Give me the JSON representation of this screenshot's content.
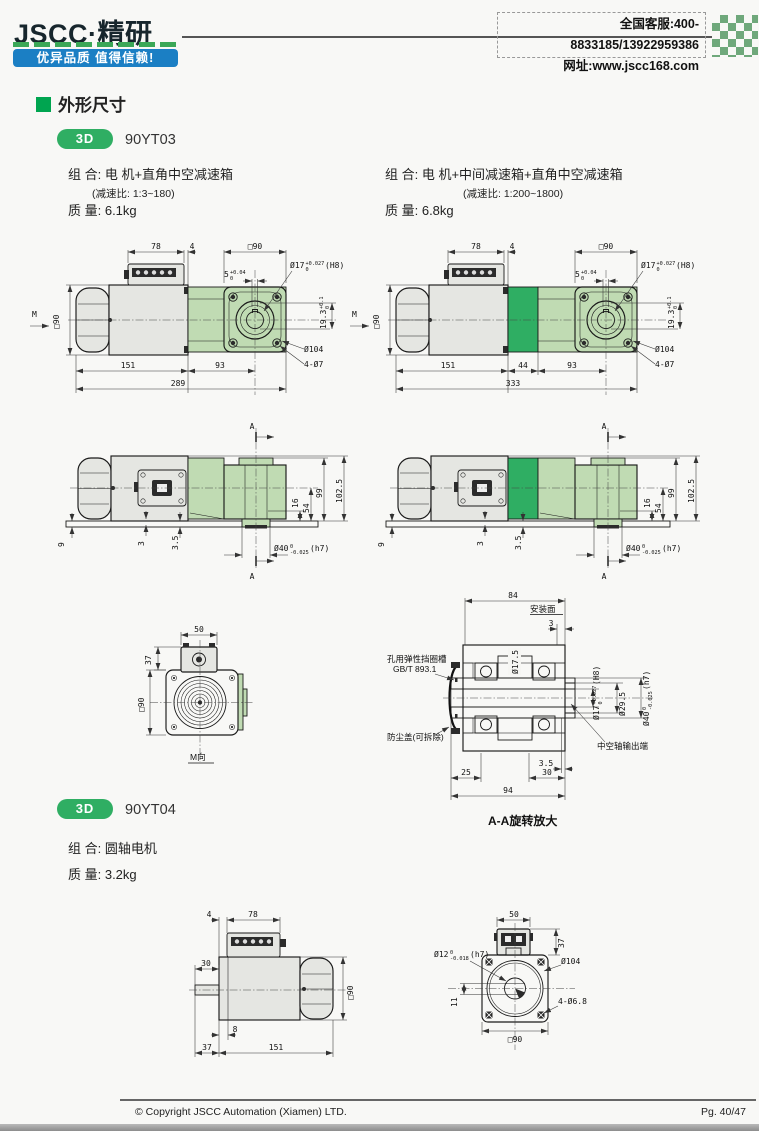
{
  "header": {
    "logo": "JSCC·精研",
    "slogan": "优异品质 值得信赖!",
    "hotline": "全国客服:400-8833185/13922959386",
    "website": "网址:www.jscc168.com"
  },
  "section": {
    "title": "外形尺寸"
  },
  "yt03": {
    "badge": "3D",
    "model": "90YT03",
    "left": {
      "combo": "组 合:  电 机+直角中空减速箱",
      "ratio": "(减速比: 1:3~180)",
      "mass": "质 量:  6.1kg"
    },
    "right": {
      "combo": "组 合:  电 机+中间减速箱+直角中空减速箱",
      "ratio": "(减速比: 1:200~1800)",
      "mass": "质 量:  6.8kg"
    }
  },
  "yt04": {
    "badge": "3D",
    "model": "90YT04",
    "combo": "组 合:  圆轴电机",
    "mass": "质 量:  3.2kg"
  },
  "labels": {
    "m": "M",
    "a": "A"
  },
  "tol": {
    "dia17": {
      "main": "Ø17",
      "sup": "+0.027",
      "sub": "0",
      "tail": "(H8)"
    },
    "key5": {
      "main": "5",
      "sup": "+0.04",
      "sub": "0",
      "tail": ""
    },
    "h193": {
      "main": "19.3",
      "sup": "+0.1",
      "sub": "0",
      "tail": ""
    },
    "dia40": {
      "main": "Ø40",
      "sup": "0",
      "sub": "-0.025",
      "tail": "(h7)"
    },
    "dia12": {
      "main": "Ø12",
      "sup": "0",
      "sub": "-0.018",
      "tail": "(h7)"
    }
  },
  "side": {
    "w78": "78",
    "w4": "4",
    "sq90": "□90",
    "b151": "151",
    "b93": "93",
    "dia104": "Ø104",
    "holes": "4-Ø7"
  },
  "d1": {
    "total": "289"
  },
  "d2": {
    "mid": "44",
    "total": "333"
  },
  "top": {
    "h16": "16",
    "h54": "54",
    "h99": "99",
    "h102": "102.5",
    "o9": "9",
    "o3": "3",
    "o35": "3.5"
  },
  "d5": {
    "w50": "50",
    "h37": "37",
    "sq90": "□90",
    "caption": "M向"
  },
  "d6": {
    "w84": "84",
    "mount": "安装面",
    "g3": "3",
    "dia175": "Ø17.5",
    "clip1": "孔用弹性挡圈槽",
    "clip2": "GB/T 893.1",
    "dust": "防尘盖(可拆除)",
    "dia295": "Ø29.5",
    "hollow": "中空轴输出端",
    "b25": "25",
    "b35": "3.5",
    "b30": "30",
    "b94": "94",
    "caption": "A-A旋转放大"
  },
  "d7": {
    "w4": "4",
    "w78": "78",
    "l30": "30",
    "sq90": "□90",
    "b8": "8",
    "b37": "37",
    "b151": "151"
  },
  "d8": {
    "w50": "50",
    "h37": "37",
    "dia104": "Ø104",
    "holes": "4-Ø6.8",
    "k11": "11",
    "sq90": "□90"
  },
  "footer": {
    "copyright": "© Copyright JSCC Automation (Xiamen) LTD.",
    "page": "Pg. 40/47"
  },
  "colors": {
    "accent_green": "#2FAE63",
    "light_green": "#C0DBB3",
    "title_green": "#00A550",
    "banner_blue": "#1B7FC4",
    "checker_green": "#6FA87B",
    "dash_green": "#3BA757"
  }
}
